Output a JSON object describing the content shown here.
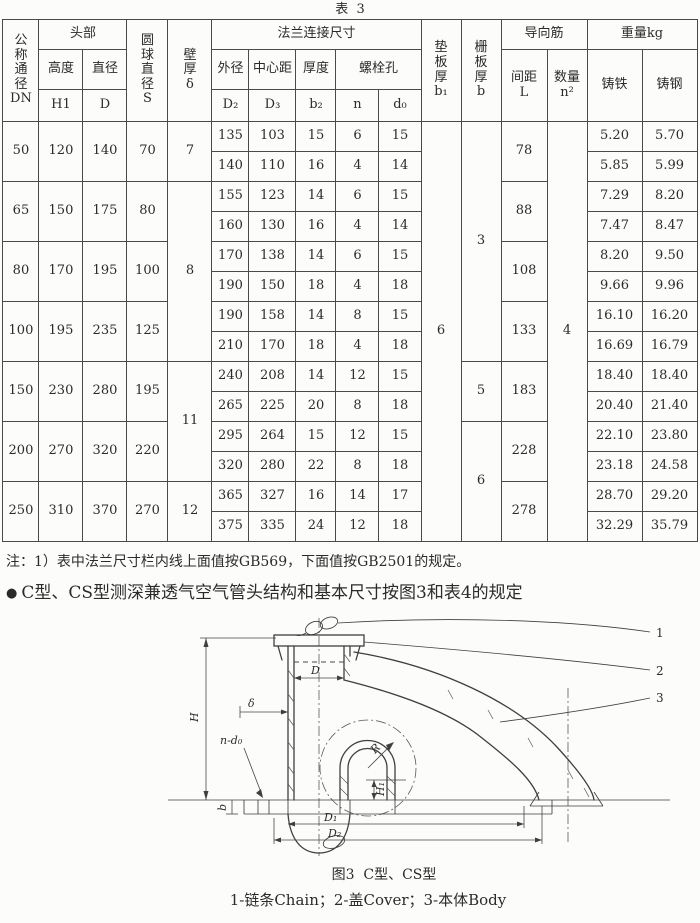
{
  "table": {
    "title": "表  3",
    "header": {
      "dn": "公\n称\n通\n径\nDN",
      "head": "头部",
      "height": "高度",
      "diameter": "直径",
      "h1": "H1",
      "d": "D",
      "s": "圆\n球\n直\n径\nS",
      "delta": "壁\n厚\nδ",
      "flange": "法兰连接尺寸",
      "od": "外径",
      "cd": "中心距",
      "thk": "厚度",
      "bolt": "螺栓孔",
      "d2": "D₂",
      "d3": "D₃",
      "b2": "b₂",
      "n": "n",
      "d0": "d₀",
      "b1": "垫\n板\n厚\nb₁",
      "b": "栅\n板\n厚\nb",
      "guide": "导向筋",
      "spacing": "间距\nL",
      "qty": "数量\nn²",
      "weight": "重量kg",
      "iron": "铸铁",
      "steel": "铸钢"
    },
    "pad_b1": "6",
    "guide_n2": "4",
    "groups": [
      {
        "dn": "50",
        "h1": "120",
        "d": "140",
        "s": "70",
        "delta": "7",
        "delta_span": 2,
        "b": "3",
        "b_span": 8,
        "l": "78",
        "flange": [
          {
            "d2": "135",
            "d3": "103",
            "b2": "15",
            "n": "6",
            "d0": "15",
            "iron": "5.20",
            "steel": "5.70"
          },
          {
            "d2": "140",
            "d3": "110",
            "b2": "16",
            "n": "4",
            "d0": "14",
            "iron": "5.85",
            "steel": "5.99"
          }
        ]
      },
      {
        "dn": "65",
        "h1": "150",
        "d": "175",
        "s": "80",
        "delta": "8",
        "delta_span": 6,
        "l": "88",
        "flange": [
          {
            "d2": "155",
            "d3": "123",
            "b2": "14",
            "n": "6",
            "d0": "15",
            "iron": "7.29",
            "steel": "8.20"
          },
          {
            "d2": "160",
            "d3": "130",
            "b2": "16",
            "n": "4",
            "d0": "14",
            "iron": "7.47",
            "steel": "8.47"
          }
        ]
      },
      {
        "dn": "80",
        "h1": "170",
        "d": "195",
        "s": "100",
        "l": "108",
        "flange": [
          {
            "d2": "170",
            "d3": "138",
            "b2": "14",
            "n": "6",
            "d0": "15",
            "iron": "8.20",
            "steel": "9.50"
          },
          {
            "d2": "190",
            "d3": "150",
            "b2": "18",
            "n": "4",
            "d0": "18",
            "iron": "9.66",
            "steel": "9.96"
          }
        ]
      },
      {
        "dn": "100",
        "h1": "195",
        "d": "235",
        "s": "125",
        "l": "133",
        "flange": [
          {
            "d2": "190",
            "d3": "158",
            "b2": "14",
            "n": "8",
            "d0": "15",
            "iron": "16.10",
            "steel": "16.20"
          },
          {
            "d2": "210",
            "d3": "170",
            "b2": "18",
            "n": "4",
            "d0": "18",
            "iron": "16.69",
            "steel": "16.79"
          }
        ]
      },
      {
        "dn": "150",
        "h1": "230",
        "d": "280",
        "s": "195",
        "delta": "11",
        "delta_span": 4,
        "b": "5",
        "b_span": 2,
        "l": "183",
        "flange": [
          {
            "d2": "240",
            "d3": "208",
            "b2": "14",
            "n": "12",
            "d0": "15",
            "iron": "18.40",
            "steel": "18.40"
          },
          {
            "d2": "265",
            "d3": "225",
            "b2": "20",
            "n": "8",
            "d0": "18",
            "iron": "20.40",
            "steel": "21.40"
          }
        ]
      },
      {
        "dn": "200",
        "h1": "270",
        "d": "320",
        "s": "220",
        "b": "6",
        "b_span": 4,
        "l": "228",
        "flange": [
          {
            "d2": "295",
            "d3": "264",
            "b2": "15",
            "n": "12",
            "d0": "15",
            "iron": "22.10",
            "steel": "23.80"
          },
          {
            "d2": "320",
            "d3": "280",
            "b2": "22",
            "n": "8",
            "d0": "18",
            "iron": "23.18",
            "steel": "24.58"
          }
        ]
      },
      {
        "dn": "250",
        "h1": "310",
        "d": "370",
        "s": "270",
        "delta": "12",
        "delta_span": 2,
        "l": "278",
        "flange": [
          {
            "d2": "365",
            "d3": "327",
            "b2": "16",
            "n": "14",
            "d0": "17",
            "iron": "28.70",
            "steel": "29.20"
          },
          {
            "d2": "375",
            "d3": "335",
            "b2": "24",
            "n": "12",
            "d0": "18",
            "iron": "32.29",
            "steel": "35.79"
          }
        ]
      }
    ]
  },
  "note": "注：1）表中法兰尺寸栏内线上面值按GB569，下面值按GB2501的规定。",
  "bullet": {
    "marker": "●",
    "text": "C型、CS型测深兼透气空气管头结构和基本尺寸按图3和表4的规定"
  },
  "figure": {
    "caption": "图3  C型、CS型",
    "legend": "1-链条Chain；2-盖Cover；3-本体Body",
    "labels": {
      "part1": "1",
      "part2": "2",
      "part3": "3",
      "h": "H",
      "d": "D",
      "delta": "δ",
      "r": "R",
      "h1": "H₁",
      "d1": "D₁",
      "d2": "D₂",
      "n_d0": "n-d₀",
      "b": "b"
    }
  }
}
